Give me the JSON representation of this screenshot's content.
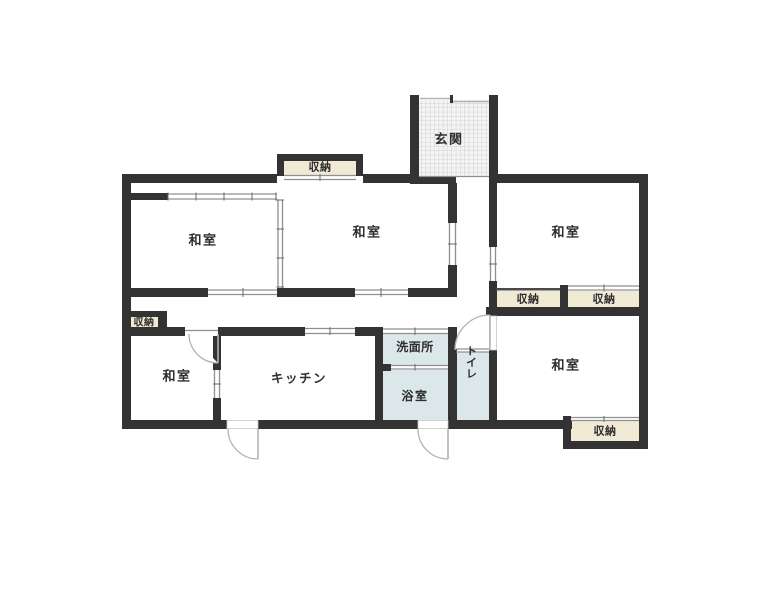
{
  "figure": {
    "type": "japanese-house-floor-plan",
    "palette": {
      "wall": "#333333",
      "storage_fill": "#f0ead5",
      "wet_area_fill": "#dce7ea",
      "entrance_hatch_bg": "#f4f4f3",
      "entrance_hatch_line": "#c9c9c9",
      "opening_line": "#8f8f8f",
      "door_arc": "#b3b3b3",
      "text": "#2e2e2e",
      "background": "#ffffff"
    },
    "rooms": [
      {
        "id": "genkan",
        "label": "玄関"
      },
      {
        "id": "washitsu-upper-left",
        "label": "和室"
      },
      {
        "id": "washitsu-upper-middle",
        "label": "和室"
      },
      {
        "id": "washitsu-upper-right",
        "label": "和室"
      },
      {
        "id": "washitsu-lower-left",
        "label": "和室"
      },
      {
        "id": "washitsu-lower-right",
        "label": "和室"
      },
      {
        "id": "kitchen",
        "label": "キッチン"
      },
      {
        "id": "washroom",
        "label": "洗面所"
      },
      {
        "id": "bathroom",
        "label": "浴室"
      },
      {
        "id": "toilet",
        "label": "トイレ"
      },
      {
        "id": "storage-top",
        "label": "収納"
      },
      {
        "id": "storage-hallway",
        "label": "収納"
      },
      {
        "id": "storage-right-a",
        "label": "収納"
      },
      {
        "id": "storage-right-b",
        "label": "収納"
      },
      {
        "id": "storage-lower-right",
        "label": "収納"
      }
    ]
  }
}
